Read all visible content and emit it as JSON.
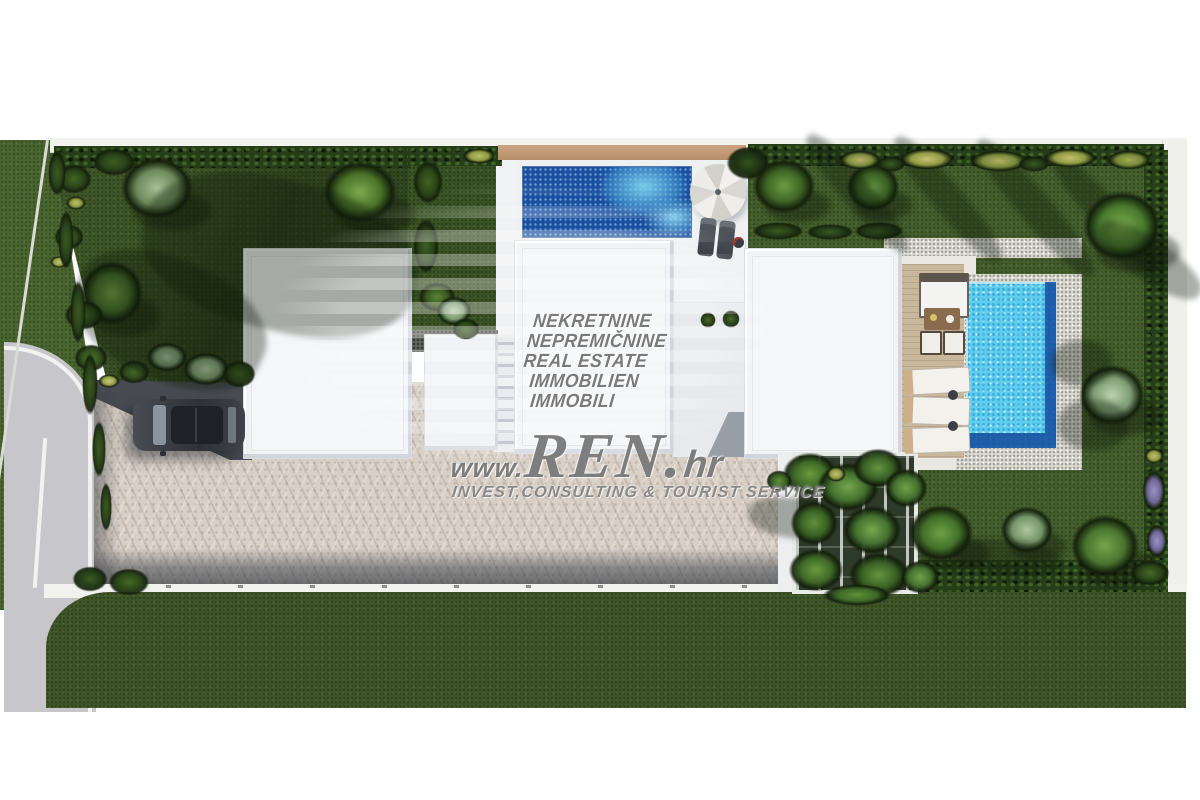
{
  "watermark": {
    "languages": [
      "NEKRETNINE",
      "NEPREMIČNINE",
      "REAL ESTATE",
      "IMMOBILIEN",
      "IMMOBILI"
    ],
    "url_prefix": "www.",
    "brand": "REN.",
    "url_suffix": "hr",
    "tagline": "INVEST,CONSULTING & TOURIST SERVICE"
  },
  "colors": {
    "background": "#ffffff",
    "lawn": "#42592a",
    "lawn_shadow": "#2a401c",
    "hedge": "#263d19",
    "road": "#c7c7cb",
    "paving": "#d8cfc6",
    "building": "#f2f3f6",
    "pool_deep_blue": "#1b4fa0",
    "pool_turquoise": "#5ecdee",
    "pool_border_blue": "#1d5cab",
    "wood_deck": "#c9b79b",
    "stone": "#dcdad2",
    "tan_wall": "#c19a76",
    "car_body": "#3a3d43",
    "watermark_text": "#686868"
  },
  "vegetation": [
    {
      "x": 120,
      "y": 156,
      "w": 74,
      "h": 64,
      "c1": "#6e8a5a",
      "c2": "#a9bf97",
      "t": "tree"
    },
    {
      "x": 322,
      "y": 160,
      "w": 76,
      "h": 64,
      "c1": "#4a7329",
      "c2": "#7fa94f",
      "t": "tree"
    },
    {
      "x": 80,
      "y": 260,
      "w": 64,
      "h": 66,
      "c1": "#466e2b",
      "c2": "#76a24a",
      "t": "tree"
    },
    {
      "x": 56,
      "y": 164,
      "w": 36,
      "h": 30,
      "c1": "#2c4519",
      "c2": "#44631f",
      "t": "bush"
    },
    {
      "x": 92,
      "y": 148,
      "w": 44,
      "h": 28,
      "c1": "#2a421a",
      "c2": "#3f5c22",
      "t": "bush"
    },
    {
      "x": 66,
      "y": 196,
      "w": 20,
      "h": 14,
      "c1": "#8f9a43",
      "c2": "#bcc46a",
      "t": "bush"
    },
    {
      "x": 54,
      "y": 224,
      "w": 30,
      "h": 26,
      "c1": "#2c4519",
      "c2": "#476627",
      "t": "bush"
    },
    {
      "x": 50,
      "y": 256,
      "w": 18,
      "h": 12,
      "c1": "#9aa24b",
      "c2": "#c2c773",
      "t": "bush"
    },
    {
      "x": 64,
      "y": 300,
      "w": 40,
      "h": 30,
      "c1": "#2e471c",
      "c2": "#49682a",
      "t": "bush"
    },
    {
      "x": 74,
      "y": 344,
      "w": 34,
      "h": 28,
      "c1": "#33501e",
      "c2": "#50722e",
      "t": "bush"
    },
    {
      "x": 146,
      "y": 342,
      "w": 42,
      "h": 30,
      "c1": "#7c9a71",
      "c2": "#b4c8a8",
      "t": "bush"
    },
    {
      "x": 182,
      "y": 352,
      "w": 48,
      "h": 34,
      "c1": "#88a47a",
      "c2": "#c2d2b4",
      "t": "bush"
    },
    {
      "x": 118,
      "y": 360,
      "w": 32,
      "h": 24,
      "c1": "#2e471c",
      "c2": "#4a6a2b",
      "t": "bush"
    },
    {
      "x": 98,
      "y": 374,
      "w": 22,
      "h": 14,
      "c1": "#9aa24b",
      "c2": "#c6cb78",
      "t": "bush"
    },
    {
      "x": 222,
      "y": 360,
      "w": 34,
      "h": 28,
      "c1": "#2c4519",
      "c2": "#466325",
      "t": "bush"
    },
    {
      "x": 140,
      "y": 180,
      "w": 280,
      "h": 150,
      "r": 14,
      "t": "shade"
    },
    {
      "x": 70,
      "y": 260,
      "w": 200,
      "h": 120,
      "r": 24,
      "t": "shade"
    },
    {
      "x": 48,
      "y": 150,
      "w": 18,
      "h": 46,
      "c1": "#2a421a",
      "c2": "#3c5a22",
      "t": "bush"
    },
    {
      "x": 58,
      "y": 210,
      "w": 16,
      "h": 60,
      "c1": "#2a421a",
      "c2": "#3c5a22",
      "t": "bush"
    },
    {
      "x": 70,
      "y": 280,
      "w": 16,
      "h": 64,
      "c1": "#2a421a",
      "c2": "#3c5a22",
      "t": "bush"
    },
    {
      "x": 82,
      "y": 352,
      "w": 16,
      "h": 64,
      "c1": "#2a421a",
      "c2": "#3c5a22",
      "t": "bush"
    },
    {
      "x": 92,
      "y": 420,
      "w": 14,
      "h": 58,
      "c1": "#2a421a",
      "c2": "#3c5a22",
      "t": "bush"
    },
    {
      "x": 100,
      "y": 482,
      "w": 12,
      "h": 50,
      "c1": "#2a421a",
      "c2": "#3c5a22",
      "t": "bush"
    },
    {
      "x": 72,
      "y": 566,
      "w": 36,
      "h": 26,
      "c1": "#253d17",
      "c2": "#3a5a22",
      "t": "bush"
    },
    {
      "x": 108,
      "y": 568,
      "w": 42,
      "h": 28,
      "c1": "#2c4719",
      "c2": "#47682a",
      "t": "bush"
    },
    {
      "x": 413,
      "y": 160,
      "w": 30,
      "h": 44,
      "c1": "#2c4519",
      "c2": "#436122",
      "t": "bush"
    },
    {
      "x": 462,
      "y": 148,
      "w": 34,
      "h": 16,
      "c1": "#8f9a43",
      "c2": "#b8bf66",
      "t": "bush"
    },
    {
      "x": 413,
      "y": 218,
      "w": 26,
      "h": 56,
      "c1": "#2a421a",
      "c2": "#3f5e24",
      "t": "bush"
    },
    {
      "x": 418,
      "y": 282,
      "w": 38,
      "h": 30,
      "c1": "#3a5a22",
      "c2": "#5d8135",
      "t": "bush"
    },
    {
      "x": 436,
      "y": 296,
      "w": 36,
      "h": 30,
      "c1": "#7c9a71",
      "c2": "#bccfae",
      "t": "bush"
    },
    {
      "x": 452,
      "y": 318,
      "w": 28,
      "h": 22,
      "c1": "#2c4519",
      "c2": "#44632a",
      "t": "bush"
    },
    {
      "x": 726,
      "y": 146,
      "w": 44,
      "h": 34,
      "c1": "#1f3314",
      "c2": "#33511e",
      "t": "bush"
    },
    {
      "x": 752,
      "y": 222,
      "w": 52,
      "h": 18,
      "c1": "#243916",
      "c2": "#3a5a22",
      "t": "bush"
    },
    {
      "x": 806,
      "y": 224,
      "w": 48,
      "h": 16,
      "c1": "#243916",
      "c2": "#3a5a22",
      "t": "bush"
    },
    {
      "x": 854,
      "y": 222,
      "w": 50,
      "h": 18,
      "c1": "#243916",
      "c2": "#3a5a22",
      "t": "bush"
    },
    {
      "x": 752,
      "y": 158,
      "w": 64,
      "h": 56,
      "c1": "#3f6526",
      "c2": "#6d9a42",
      "t": "tree"
    },
    {
      "x": 846,
      "y": 162,
      "w": 54,
      "h": 50,
      "c1": "#3a5f23",
      "c2": "#639140",
      "t": "tree"
    },
    {
      "x": 782,
      "y": 178,
      "w": 150,
      "h": 30,
      "r": 50,
      "t": "shade"
    },
    {
      "x": 868,
      "y": 184,
      "w": 160,
      "h": 30,
      "r": 50,
      "t": "shade"
    },
    {
      "x": 948,
      "y": 192,
      "w": 175,
      "h": 32,
      "r": 50,
      "t": "shade"
    },
    {
      "x": 1030,
      "y": 198,
      "w": 150,
      "h": 30,
      "r": 48,
      "t": "shade"
    },
    {
      "x": 838,
      "y": 150,
      "w": 44,
      "h": 20,
      "c1": "#7e8c3e",
      "c2": "#b6b264",
      "t": "bush"
    },
    {
      "x": 898,
      "y": 148,
      "w": 58,
      "h": 22,
      "c1": "#8f9a43",
      "c2": "#c8c273",
      "t": "bush"
    },
    {
      "x": 968,
      "y": 150,
      "w": 62,
      "h": 22,
      "c1": "#79893c",
      "c2": "#b2b05e",
      "t": "bush"
    },
    {
      "x": 1042,
      "y": 148,
      "w": 56,
      "h": 20,
      "c1": "#8f9a43",
      "c2": "#c4bd6d",
      "t": "bush"
    },
    {
      "x": 1106,
      "y": 150,
      "w": 46,
      "h": 20,
      "c1": "#76863a",
      "c2": "#a8aa56",
      "t": "bush"
    },
    {
      "x": 876,
      "y": 156,
      "w": 30,
      "h": 16,
      "c1": "#243916",
      "c2": "#3a5a22",
      "t": "bush"
    },
    {
      "x": 1018,
      "y": 156,
      "w": 32,
      "h": 16,
      "c1": "#243916",
      "c2": "#3a5a22",
      "t": "bush"
    },
    {
      "x": 1082,
      "y": 190,
      "w": 80,
      "h": 72,
      "c1": "#4a7a2e",
      "c2": "#7cab4e",
      "t": "tree"
    },
    {
      "x": 1090,
      "y": 240,
      "w": 120,
      "h": 40,
      "r": 35,
      "t": "shade"
    },
    {
      "x": 1078,
      "y": 364,
      "w": 68,
      "h": 62,
      "c1": "#7e9c74",
      "c2": "#bdd2b0",
      "t": "tree"
    },
    {
      "x": 1052,
      "y": 340,
      "w": 60,
      "h": 46,
      "r": 0,
      "t": "shade"
    },
    {
      "x": 1058,
      "y": 400,
      "w": 70,
      "h": 50,
      "r": 0,
      "t": "shade"
    },
    {
      "x": 908,
      "y": 504,
      "w": 66,
      "h": 58,
      "c1": "#42702a",
      "c2": "#6fa045",
      "t": "tree"
    },
    {
      "x": 1000,
      "y": 506,
      "w": 54,
      "h": 48,
      "c1": "#76956a",
      "c2": "#aec69e",
      "t": "tree"
    },
    {
      "x": 1070,
      "y": 514,
      "w": 70,
      "h": 64,
      "c1": "#4a7430",
      "c2": "#79a44c",
      "t": "tree"
    },
    {
      "x": 748,
      "y": 498,
      "w": 90,
      "h": 40,
      "r": 8,
      "t": "shade"
    },
    {
      "x": 952,
      "y": 540,
      "w": 110,
      "h": 36,
      "r": 6,
      "t": "shade"
    },
    {
      "x": 1142,
      "y": 470,
      "w": 24,
      "h": 42,
      "c1": "#6f6796",
      "c2": "#9b93c0",
      "t": "bush"
    },
    {
      "x": 1146,
      "y": 524,
      "w": 22,
      "h": 34,
      "c1": "#6f6796",
      "c2": "#9b93c0",
      "t": "bush"
    },
    {
      "x": 1144,
      "y": 448,
      "w": 20,
      "h": 16,
      "c1": "#8f9a43",
      "c2": "#c2bd6e",
      "t": "bush"
    },
    {
      "x": 1130,
      "y": 560,
      "w": 40,
      "h": 26,
      "c1": "#2c4519",
      "c2": "#486828",
      "t": "bush"
    },
    {
      "x": 782,
      "y": 452,
      "w": 56,
      "h": 44,
      "c1": "#3f6a28",
      "c2": "#6b9a3f",
      "t": "bush"
    },
    {
      "x": 816,
      "y": 462,
      "w": 64,
      "h": 50,
      "c1": "#447030",
      "c2": "#76a74a",
      "t": "bush"
    },
    {
      "x": 852,
      "y": 448,
      "w": 52,
      "h": 40,
      "c1": "#3a6125",
      "c2": "#659540",
      "t": "bush"
    },
    {
      "x": 884,
      "y": 468,
      "w": 44,
      "h": 40,
      "c1": "#447030",
      "c2": "#72a247",
      "t": "bush"
    },
    {
      "x": 790,
      "y": 500,
      "w": 48,
      "h": 46,
      "c1": "#3a6125",
      "c2": "#5f8f3a",
      "t": "bush"
    },
    {
      "x": 842,
      "y": 505,
      "w": 60,
      "h": 50,
      "c1": "#447030",
      "c2": "#78a84c",
      "t": "bush"
    },
    {
      "x": 788,
      "y": 548,
      "w": 56,
      "h": 44,
      "c1": "#3f6a28",
      "c2": "#6b9b40",
      "t": "bush"
    },
    {
      "x": 848,
      "y": 552,
      "w": 62,
      "h": 46,
      "c1": "#3a6125",
      "c2": "#659540",
      "t": "bush"
    },
    {
      "x": 822,
      "y": 584,
      "w": 70,
      "h": 22,
      "c1": "#3f6a28",
      "c2": "#5f8f3a",
      "t": "bush"
    },
    {
      "x": 826,
      "y": 466,
      "w": 20,
      "h": 16,
      "c1": "#8f9a43",
      "c2": "#c4c06f",
      "t": "bush"
    },
    {
      "x": 900,
      "y": 560,
      "w": 40,
      "h": 34,
      "c1": "#447030",
      "c2": "#72a247",
      "t": "bush"
    },
    {
      "x": 766,
      "y": 470,
      "w": 26,
      "h": 22,
      "c1": "#3a6125",
      "c2": "#608f3b",
      "t": "bush"
    },
    {
      "x": 700,
      "y": 312,
      "w": 16,
      "h": 16,
      "c1": "#2c4519",
      "c2": "#4a6a2b",
      "t": "bush"
    },
    {
      "x": 722,
      "y": 310,
      "w": 18,
      "h": 18,
      "c1": "#2c4519",
      "c2": "#4a6a2b",
      "t": "bush"
    }
  ]
}
